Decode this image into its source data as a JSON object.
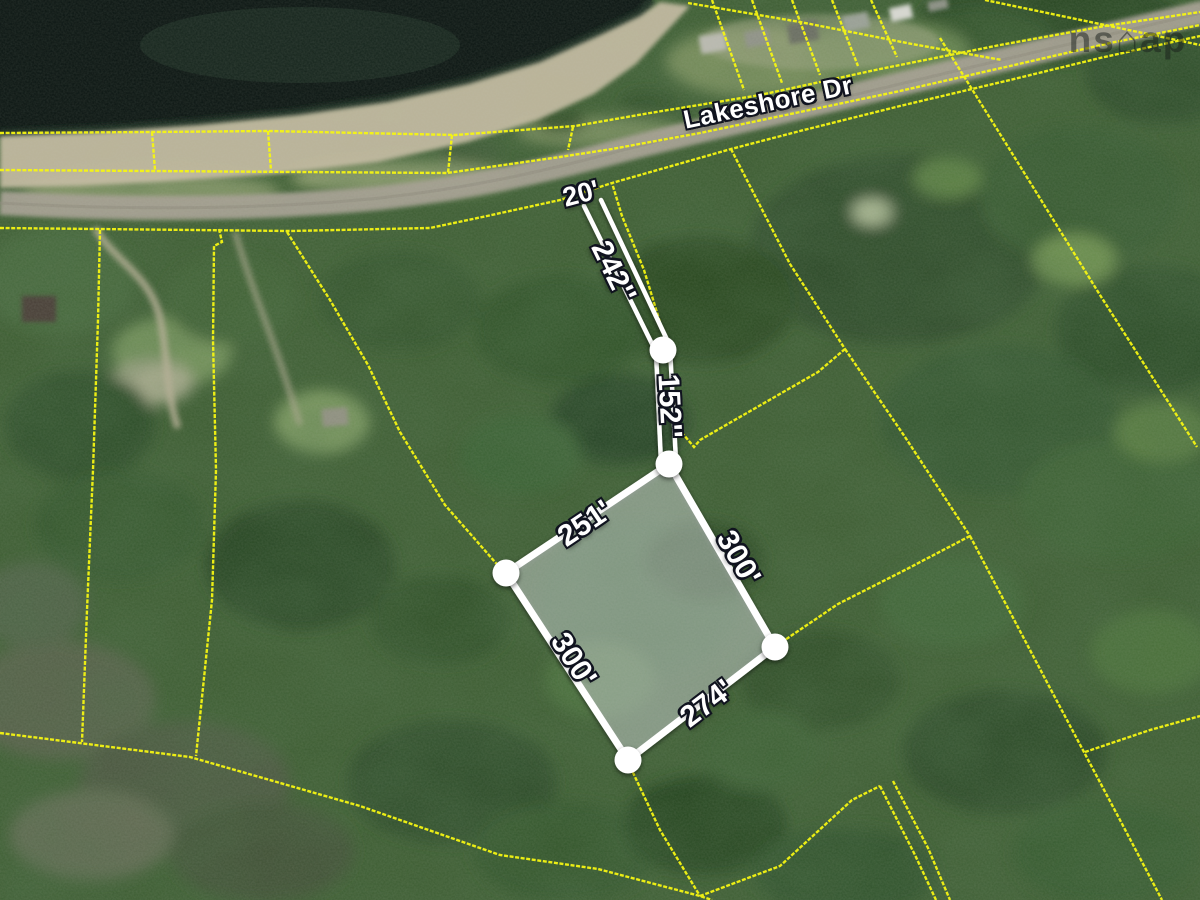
{
  "map_view": {
    "road_label": "Lakeshore Dr",
    "watermark": "ns⌂ap",
    "measurement_labels": {
      "frontage": "20'",
      "right_of_way_upper": "242''",
      "right_of_way_lower": "152''",
      "edge_top_left": "251'",
      "edge_right": "300'",
      "edge_bottom_left": "300'",
      "edge_bottom": "274'"
    },
    "colors": {
      "parcel_boundary_yellow": "#f5f513",
      "highlight_white": "#ffffff",
      "water_dark": "#0b1512",
      "road_grey": "#a49f91",
      "beach_tan": "#c8bda4",
      "label_text": "#ffffff",
      "label_outline": "#10131f"
    }
  }
}
